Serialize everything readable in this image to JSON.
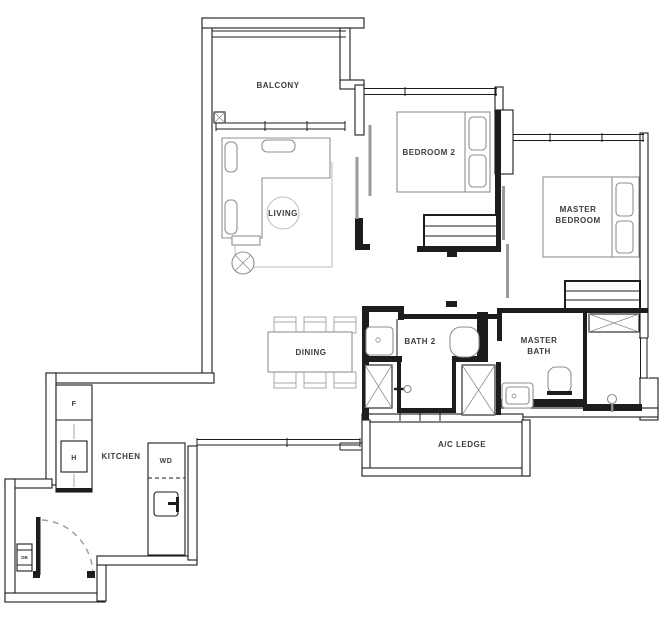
{
  "plan": {
    "rooms": {
      "balcony": "BALCONY",
      "living": "LIVING",
      "bedroom2": "BEDROOM 2",
      "master_bedroom_line1": "MASTER",
      "master_bedroom_line2": "BEDROOM",
      "dining": "DINING",
      "bath2": "BATH 2",
      "master_bath_line1": "MASTER",
      "master_bath_line2": "BATH",
      "ac_ledge": "A/C LEDGE",
      "kitchen": "KITCHEN"
    },
    "appliances": {
      "fridge": "F",
      "hob": "H",
      "washer_dryer": "WD",
      "db_box": "DB"
    },
    "colors": {
      "wall": "#1d1d1d",
      "furniture": "#8f8f8f",
      "light_furniture": "#bdbdbd",
      "label": "#3c3c3c",
      "sliding_panel": "#9a9a9a",
      "background": "#ffffff"
    }
  }
}
